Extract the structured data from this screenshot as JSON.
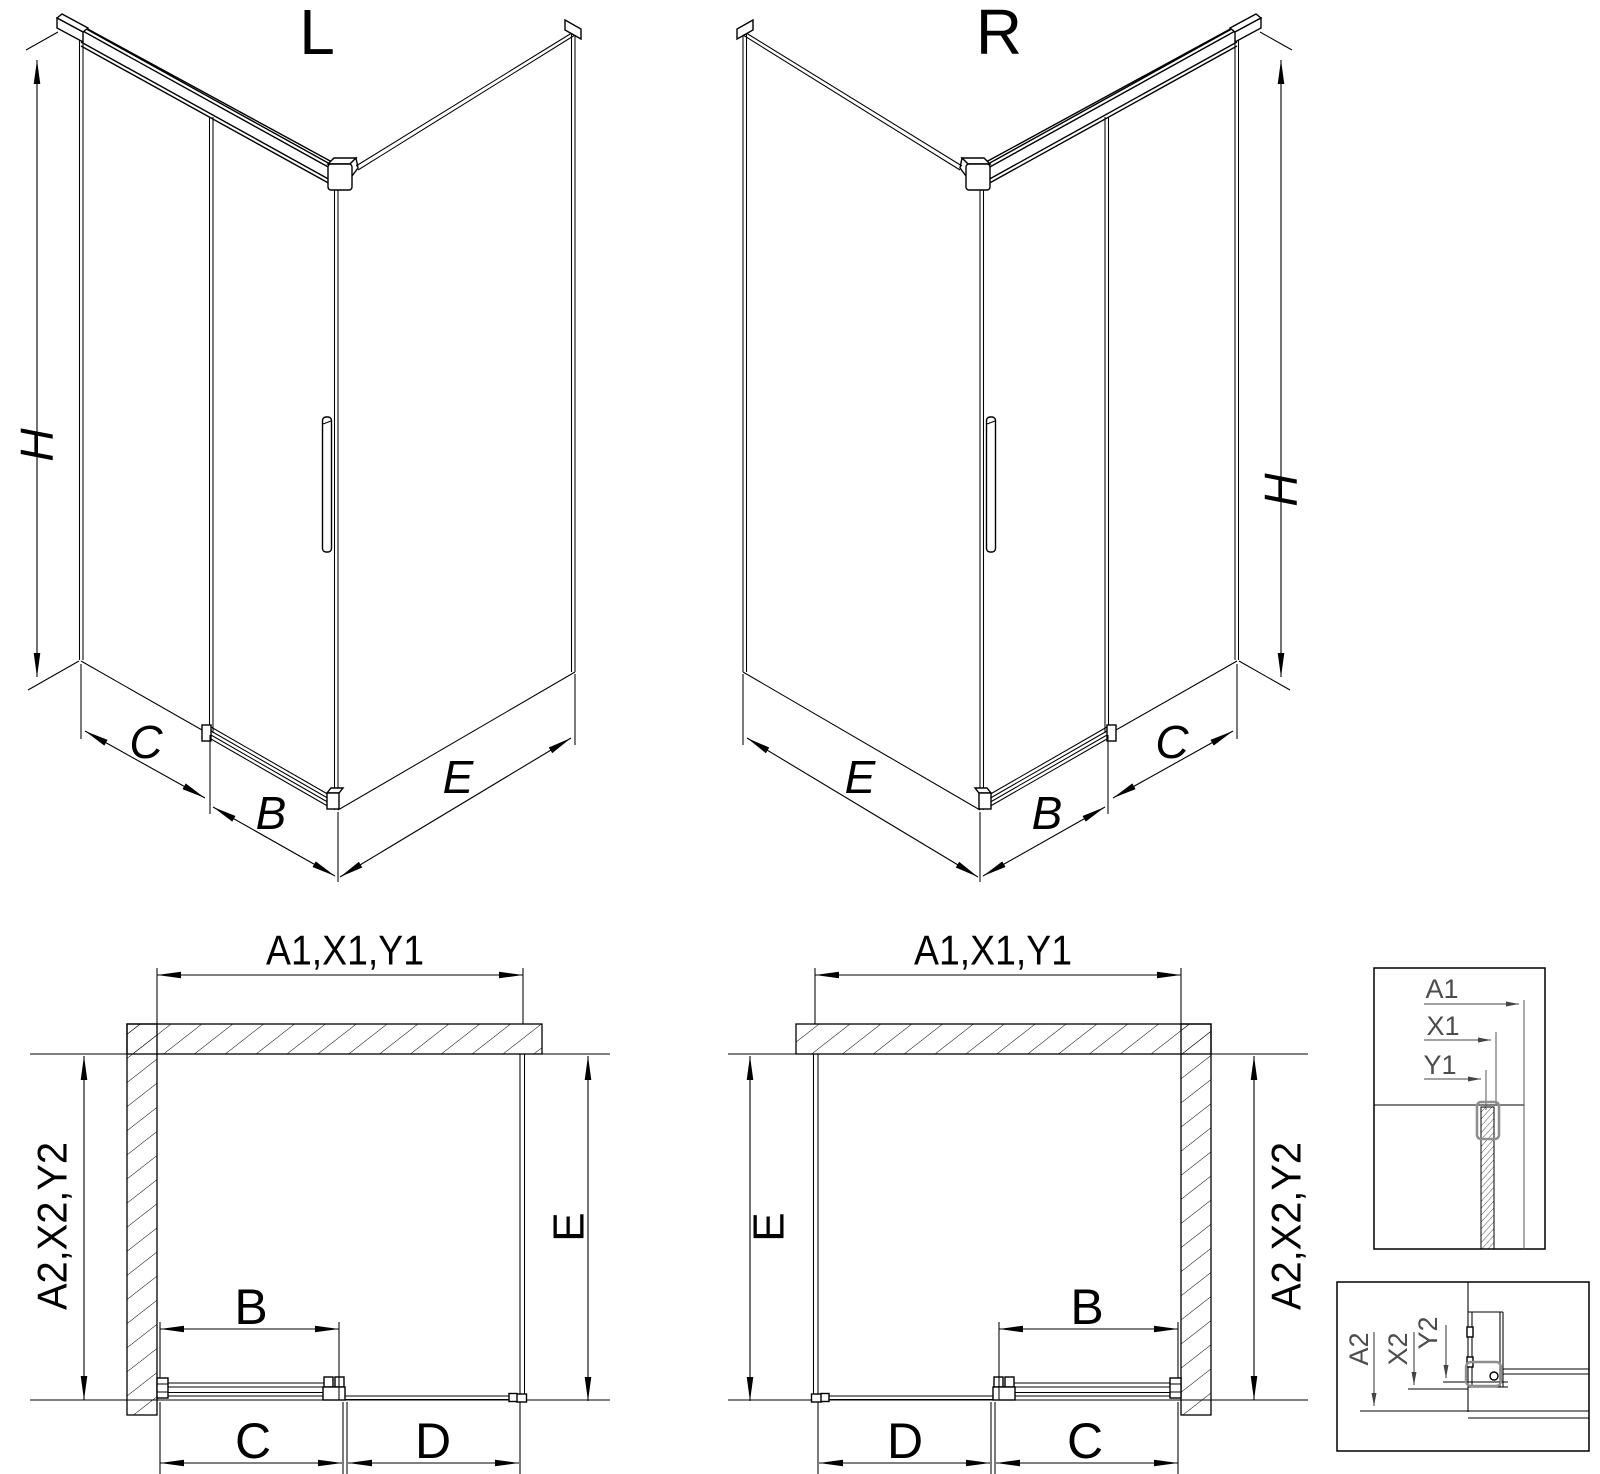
{
  "drawing": {
    "iso_left": {
      "title": "L",
      "dim_height": "H",
      "dim_panel": "C",
      "dim_door": "B",
      "dim_side": "E"
    },
    "iso_right": {
      "title": "R",
      "dim_height": "H",
      "dim_panel": "C",
      "dim_door": "B",
      "dim_side": "E"
    },
    "plan_left": {
      "dim_top": "A1,X1,Y1",
      "dim_left": "A2,X2,Y2",
      "dim_door": "B",
      "dim_c": "C",
      "dim_d": "D",
      "dim_side": "E"
    },
    "plan_right": {
      "dim_top": "A1,X1,Y1",
      "dim_right": "A2,X2,Y2",
      "dim_door": "B",
      "dim_c": "C",
      "dim_d": "D",
      "dim_side": "E"
    },
    "detail_top": {
      "dim_a": "A1",
      "dim_x": "X1",
      "dim_y": "Y1"
    },
    "detail_bottom": {
      "dim_a": "A2",
      "dim_x": "X2",
      "dim_y": "Y2"
    }
  },
  "colors": {
    "line": "#000000",
    "hardware_gray": "#8f8f8f",
    "detail_text": "#4d4d4d",
    "background": "#ffffff"
  }
}
